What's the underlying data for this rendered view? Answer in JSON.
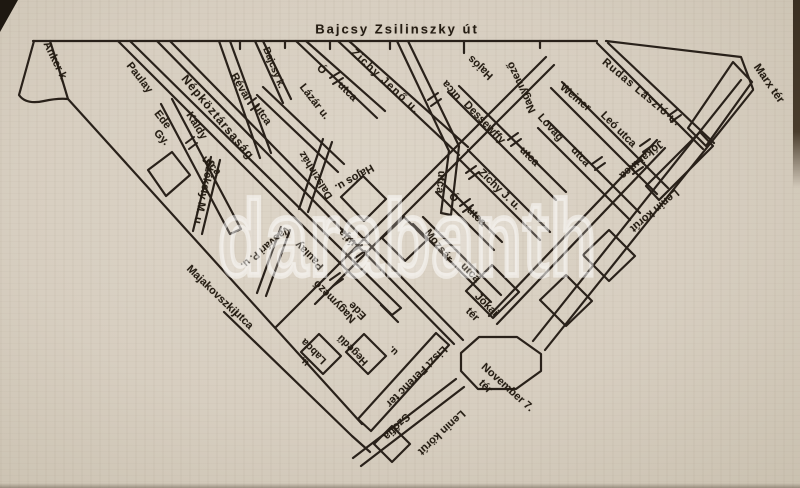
{
  "page": {
    "kind": "scanned book street map",
    "colors": {
      "paper": "#d7cec0",
      "ink": "#29211a",
      "watermark": "rgba(255,255,255,0.5)"
    }
  },
  "watermark": {
    "text": "darabanth"
  },
  "map": {
    "title_street": "Bajcsy Zsilinszky út",
    "squares": [
      "Marx tér",
      "Jókai tér",
      "Liszt Ferenc tér",
      "November 7. tér"
    ],
    "labels": [
      {
        "t": "Bajcsy Zsilinszky út",
        "x": 397,
        "y": 29,
        "r": 0,
        "s": 13,
        "ls": 2
      },
      {
        "t": "Anker k.",
        "x": 55,
        "y": 62,
        "r": 64
      },
      {
        "t": "Paulay",
        "x": 139,
        "y": 78,
        "r": 52
      },
      {
        "t": "Ede",
        "x": 162,
        "y": 120,
        "r": 52
      },
      {
        "t": "Káldy",
        "x": 196,
        "y": 126,
        "r": 58
      },
      {
        "t": "Gy.",
        "x": 161,
        "y": 138,
        "r": 46
      },
      {
        "t": "utca",
        "x": 211,
        "y": 166,
        "r": 46
      },
      {
        "t": "Népköztársaság",
        "x": 218,
        "y": 117,
        "r": 50,
        "s": 12,
        "ls": 1
      },
      {
        "t": "útja",
        "x": 348,
        "y": 237,
        "r": -135
      },
      {
        "t": "Révai",
        "x": 240,
        "y": 87,
        "r": 60
      },
      {
        "t": "utca",
        "x": 262,
        "y": 115,
        "r": 55
      },
      {
        "t": "Bajcsy k.",
        "x": 273,
        "y": 68,
        "r": 68,
        "s": 10
      },
      {
        "t": "Lázár u.",
        "x": 314,
        "y": 102,
        "r": 52
      },
      {
        "t": "Ó",
        "x": 321,
        "y": 70,
        "r": 45
      },
      {
        "t": "utca",
        "x": 347,
        "y": 92,
        "r": 45
      },
      {
        "t": "Zichy Jenő u.",
        "x": 385,
        "y": 82,
        "r": 43,
        "ls": 1.5
      },
      {
        "t": "Hajós",
        "x": 481,
        "y": 67,
        "r": -137
      },
      {
        "t": "utca",
        "x": 452,
        "y": 90,
        "r": -130
      },
      {
        "t": "utca",
        "x": 440,
        "y": 182,
        "r": 95
      },
      {
        "t": "Dessewffy",
        "x": 484,
        "y": 123,
        "r": 46
      },
      {
        "t": "utca",
        "x": 529,
        "y": 157,
        "r": 45
      },
      {
        "t": "Nagymező",
        "x": 522,
        "y": 87,
        "r": -115
      },
      {
        "t": "Lovag",
        "x": 550,
        "y": 128,
        "r": 48
      },
      {
        "t": "utca",
        "x": 580,
        "y": 157,
        "r": 48
      },
      {
        "t": "Weiner",
        "x": 575,
        "y": 98,
        "r": 40
      },
      {
        "t": "Leó utca",
        "x": 618,
        "y": 130,
        "r": 45
      },
      {
        "t": "Rudas László u.",
        "x": 641,
        "y": 93,
        "r": 40,
        "ls": 1
      },
      {
        "t": "Marx tér",
        "x": 768,
        "y": 84,
        "r": 55,
        "s": 11.5
      },
      {
        "t": "Jókai utca",
        "x": 641,
        "y": 159,
        "r": 140
      },
      {
        "t": "Lenin körút",
        "x": 654,
        "y": 210,
        "r": 140
      },
      {
        "t": "Zichy J. u.",
        "x": 499,
        "y": 190,
        "r": 44
      },
      {
        "t": "Ó",
        "x": 453,
        "y": 198,
        "r": 45
      },
      {
        "t": "utca",
        "x": 476,
        "y": 217,
        "r": 45
      },
      {
        "t": "Mozsár",
        "x": 438,
        "y": 246,
        "r": 52
      },
      {
        "t": "utca",
        "x": 470,
        "y": 273,
        "r": 45
      },
      {
        "t": "Jókai",
        "x": 486,
        "y": 305,
        "r": 45
      },
      {
        "t": "tér",
        "x": 472,
        "y": 315,
        "r": 45
      },
      {
        "t": "Székely M. u.",
        "x": 203,
        "y": 193,
        "r": 102
      },
      {
        "t": "Dalszínház",
        "x": 316,
        "y": 175,
        "r": -122,
        "s": 10.5
      },
      {
        "t": "Hajós u.",
        "x": 354,
        "y": 177,
        "r": 150
      },
      {
        "t": "Vasvári P. u.",
        "x": 265,
        "y": 247,
        "r": 140,
        "s": 10.5
      },
      {
        "t": "Paulay",
        "x": 310,
        "y": 255,
        "r": -135
      },
      {
        "t": "Nagymező",
        "x": 335,
        "y": 301,
        "r": -135
      },
      {
        "t": "Ede",
        "x": 358,
        "y": 310,
        "r": -135
      },
      {
        "t": "Majakovszkij",
        "x": 212,
        "y": 291,
        "r": 44
      },
      {
        "t": "utca",
        "x": 243,
        "y": 320,
        "r": 45
      },
      {
        "t": "Labda",
        "x": 314,
        "y": 351,
        "r": -135,
        "s": 10.5
      },
      {
        "t": "u.",
        "x": 305,
        "y": 361,
        "r": -135,
        "s": 10
      },
      {
        "t": "Hegedű",
        "x": 353,
        "y": 350,
        "r": -135,
        "s": 10.5
      },
      {
        "t": "u.",
        "x": 394,
        "y": 350,
        "r": -135,
        "s": 10
      },
      {
        "t": "Liszt Ferenc tér",
        "x": 416,
        "y": 376,
        "r": 135
      },
      {
        "t": "Szófia",
        "x": 396,
        "y": 426,
        "r": 135
      },
      {
        "t": "Lenin körút",
        "x": 441,
        "y": 432,
        "r": 137
      },
      {
        "t": "November 7.",
        "x": 507,
        "y": 388,
        "r": 42
      },
      {
        "t": "tér",
        "x": 485,
        "y": 387,
        "r": 45
      }
    ]
  }
}
